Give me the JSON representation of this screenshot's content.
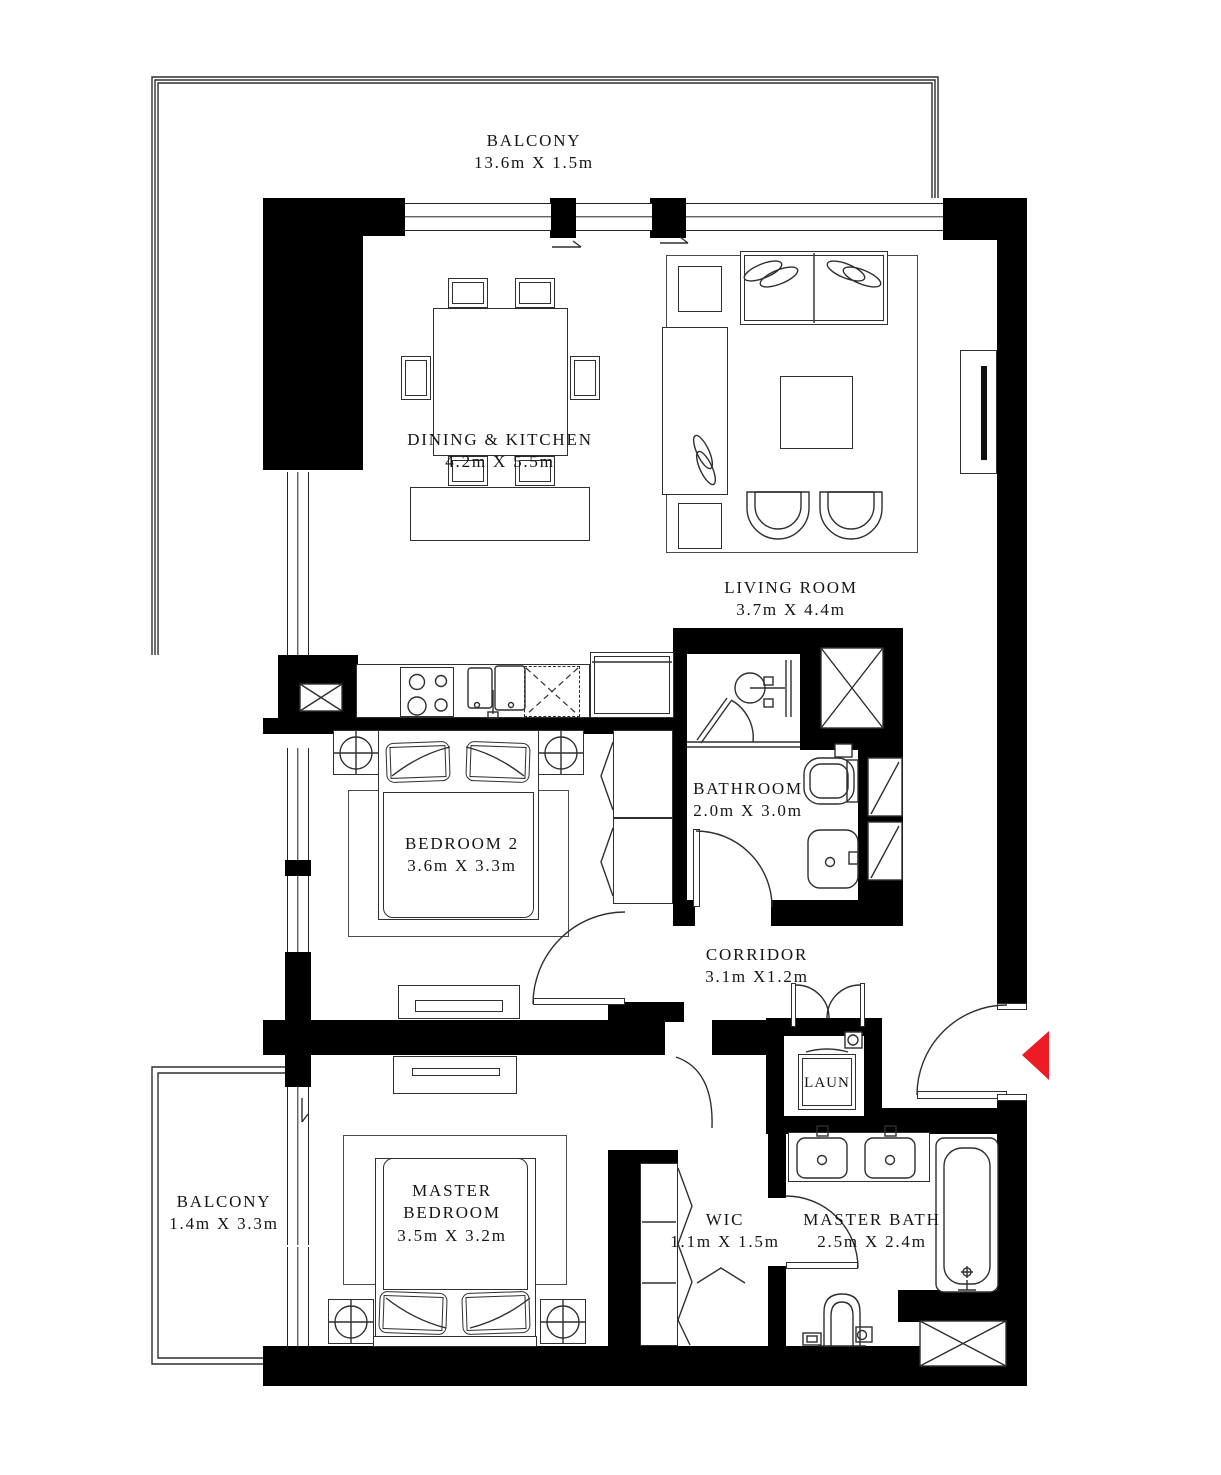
{
  "colors": {
    "wall": "#000000",
    "line": "#2f2f2f",
    "entry_arrow": "#ed1c24"
  },
  "rooms": {
    "balcony_top": {
      "name": "BALCONY",
      "dims": "13.6m X 1.5m"
    },
    "dining_kitchen": {
      "name": "DINING & KITCHEN",
      "dims": "4.2m X 5.5m"
    },
    "living_room": {
      "name": "LIVING ROOM",
      "dims": "3.7m X 4.4m"
    },
    "bathroom": {
      "name": "BATHROOM",
      "dims": "2.0m X 3.0m"
    },
    "bedroom_2": {
      "name": "BEDROOM 2",
      "dims": "3.6m X 3.3m"
    },
    "corridor": {
      "name": "CORRIDOR",
      "dims": "3.1m X1.2m"
    },
    "laundry": {
      "name": "LAUN"
    },
    "balcony_left": {
      "name": "BALCONY",
      "dims": "1.4m X 3.3m"
    },
    "master_bedroom": {
      "name": "MASTER BEDROOM",
      "dims": "3.5m X 3.2m"
    },
    "wic": {
      "name": "WIC",
      "dims": "1.1m X 1.5m"
    },
    "master_bath": {
      "name": "MASTER BATH",
      "dims": "2.5m X 2.4m"
    }
  }
}
